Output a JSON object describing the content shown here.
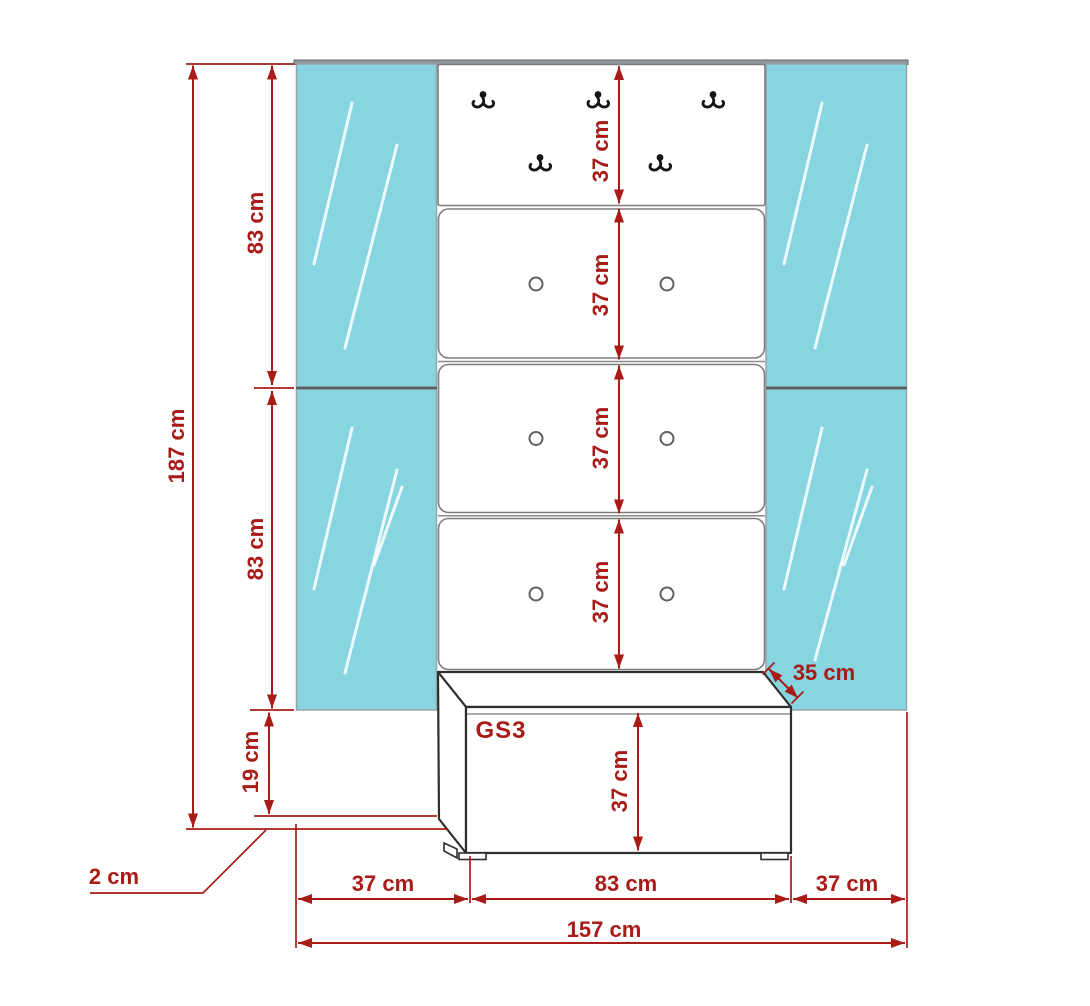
{
  "model_label": "GS3",
  "dims": {
    "total_height": "187 cm",
    "upper_mirror_height": "83 cm",
    "lower_mirror_height": "83 cm",
    "base_gap_height": "19 cm",
    "foot_height": "2 cm",
    "hook_panel_height": "37 cm",
    "cabinet1_height": "37 cm",
    "cabinet2_height": "37 cm",
    "cabinet3_height": "37 cm",
    "bench_height": "37 cm",
    "bench_depth": "35 cm",
    "left_width": "37 cm",
    "center_width": "83 cm",
    "right_width": "37 cm",
    "total_width": "157 cm"
  },
  "colors": {
    "dimension_red": "#a81b17",
    "mirror_glass": "#86d5e0",
    "bench_outline": "#2e2e2e",
    "panel_border": "#7d7d7d"
  },
  "icons": {
    "coat_hook": "double-prong-wall-hook",
    "knob": "round-door-knob"
  }
}
